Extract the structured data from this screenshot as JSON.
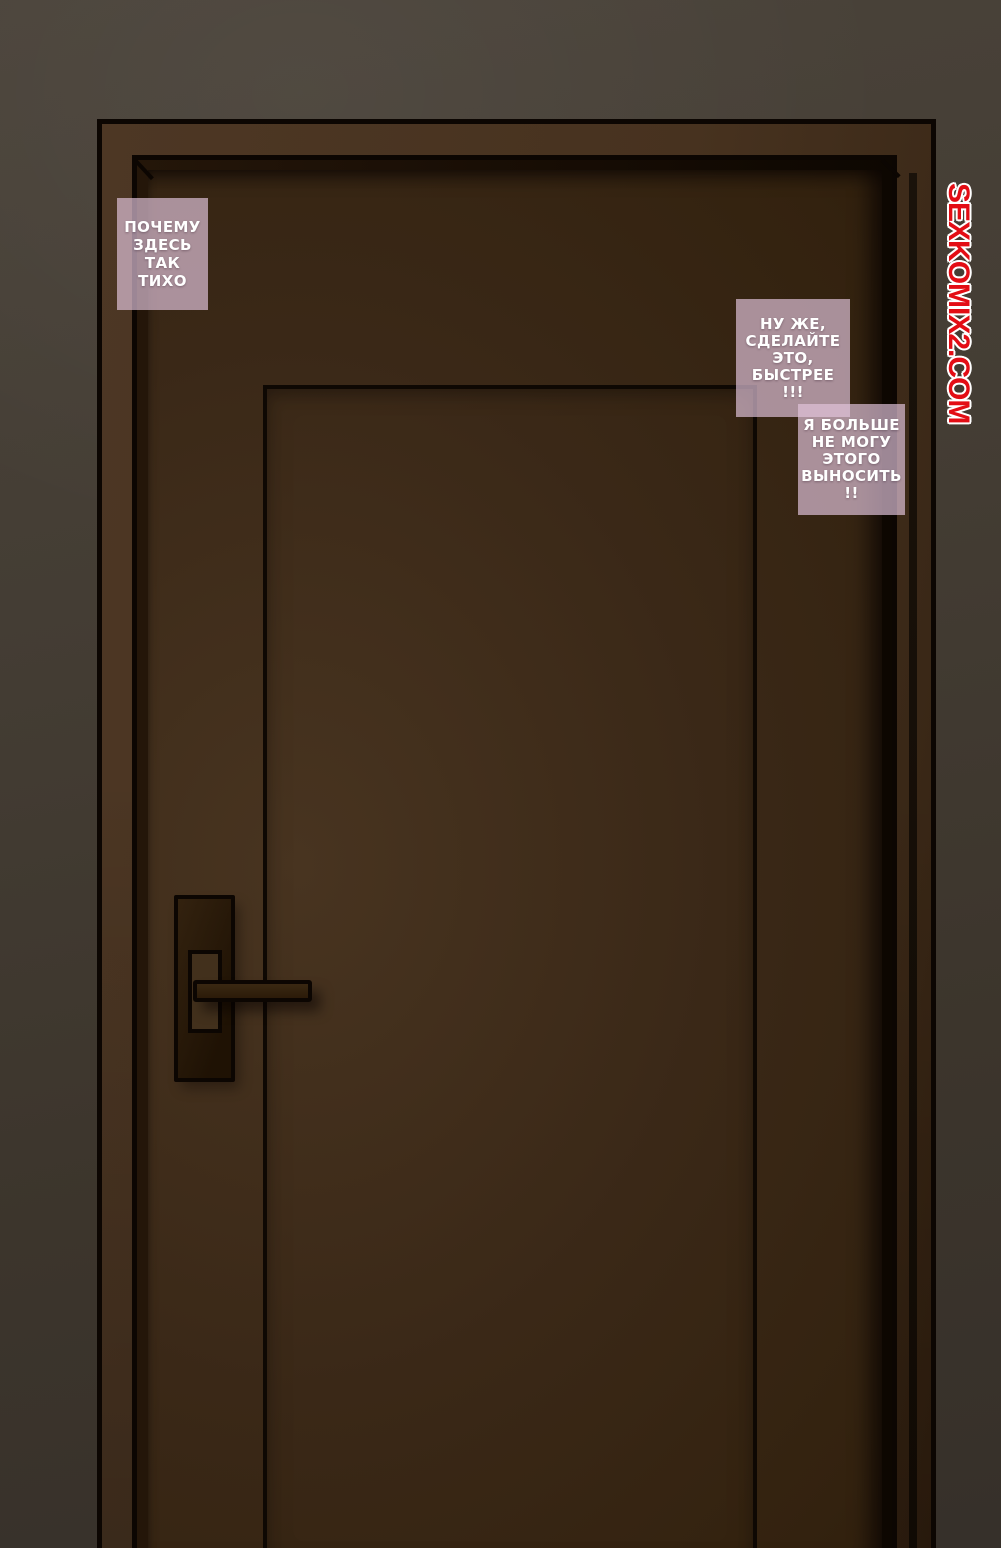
{
  "panel": {
    "watermark": {
      "text": "SEXKOMIX2.COM"
    },
    "bubbles": [
      {
        "name": "bubble-why-quiet",
        "lines": [
          "ПОЧЕМУ",
          "ЗДЕСЬ",
          "ТАК",
          "ТИХО"
        ]
      },
      {
        "name": "bubble-do-it-faster",
        "lines": [
          "НУ ЖЕ,",
          "СДЕЛАЙТЕ",
          "ЭТО,",
          "БЫСТРЕЕ",
          "!!!"
        ]
      },
      {
        "name": "bubble-cant-stand-it",
        "lines": [
          "Я БОЛЬШЕ",
          "НЕ МОГУ",
          "ЭТОГО",
          "ВЫНОСИТЬ",
          "!!"
        ]
      }
    ]
  },
  "palette": {
    "wall-light": "#4a433a",
    "wall-dark": "#36302a",
    "frame-light": "#4d3724",
    "frame-dark": "#33200f",
    "door-light": "#483420",
    "door-mid": "#3a2817",
    "door-dark": "#2b1a0a",
    "outline": "#0c0602",
    "reveal": "#190e05",
    "bubble-bg": "rgba(226,196,219,0.68)",
    "bubble-text": "#ffffff",
    "watermark-red": "#e30d15",
    "watermark-outline": "#ffffff"
  }
}
